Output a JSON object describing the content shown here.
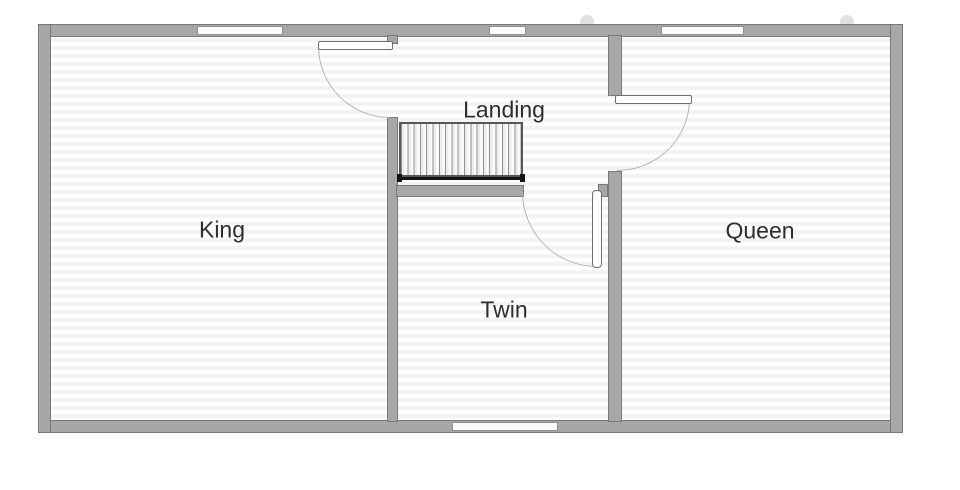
{
  "plan": {
    "rooms": {
      "king": {
        "label": "King"
      },
      "landing": {
        "label": "Landing"
      },
      "twin": {
        "label": "Twin"
      },
      "queen": {
        "label": "Queen"
      }
    },
    "colors": {
      "wall_fill": "#a7a7a7",
      "wall_edge": "#787878",
      "floor_stripe": "#f3f3f3",
      "floor_base": "#ffffff",
      "window_fill": "#fcfcfc",
      "door_arc": "#b5b5b5",
      "stair_rail": "#141414",
      "label_text": "#2d2d2d"
    }
  }
}
